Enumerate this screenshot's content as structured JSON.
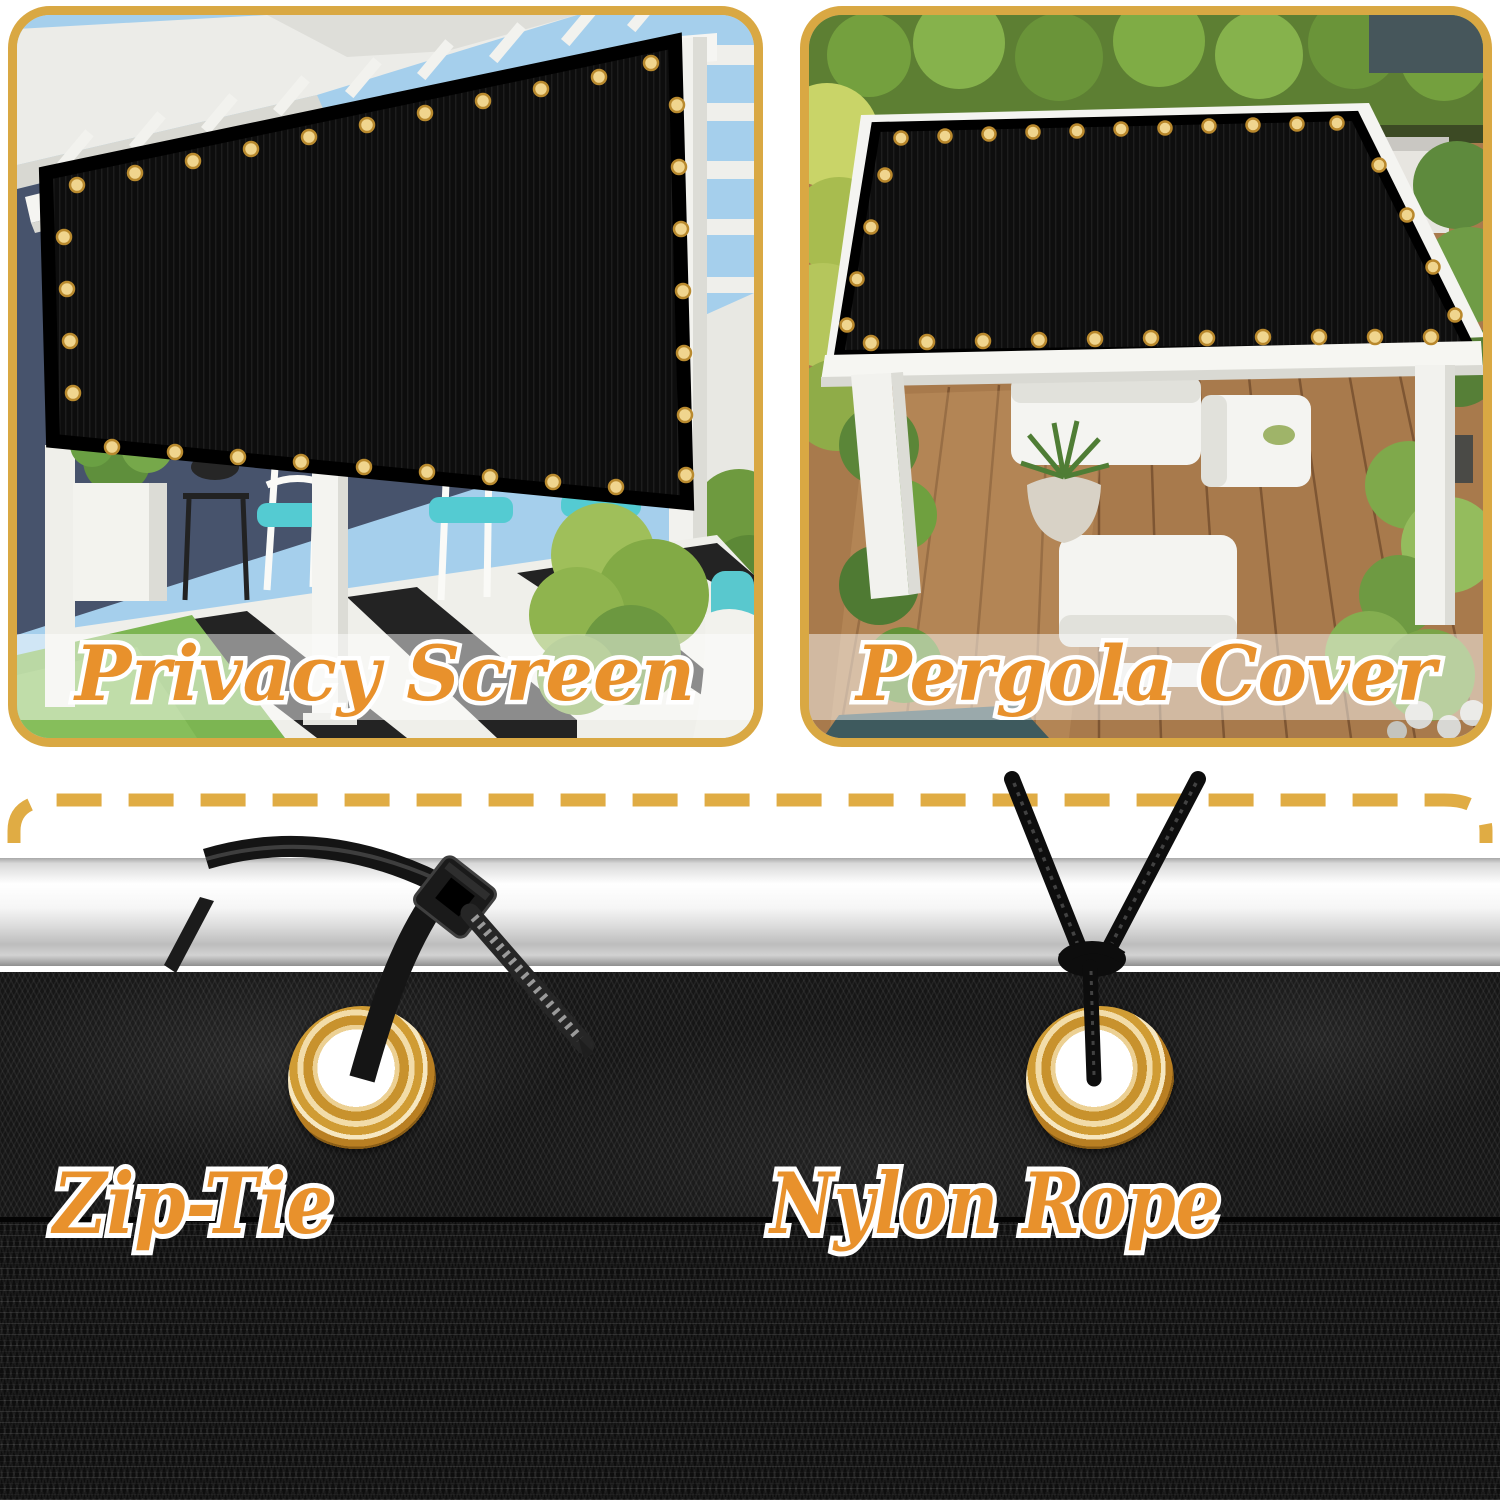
{
  "panels": [
    {
      "label": "Privacy Screen"
    },
    {
      "label": "Pergola Cover"
    }
  ],
  "mount_labels": [
    {
      "label": "Zip-Tie"
    },
    {
      "label": "Nylon Rope"
    }
  ],
  "colors": {
    "panel_border_gold": "#D9A843",
    "dashed_line_gold": "#E0AC44",
    "label_orange": "#E8912C",
    "label_outline_white": "#FFFFFF",
    "grommet_brass": "#D09C34",
    "mesh_black": "#141414",
    "pole_silver": "#D9D9D9",
    "cushion_teal": "#54CBD2"
  },
  "icons": {
    "grommet": "grommet-icon",
    "zip_tie": "zip-tie-icon",
    "nylon_rope": "nylon-rope-icon",
    "dashed_cut_line": "dashed-cut-line-icon"
  }
}
